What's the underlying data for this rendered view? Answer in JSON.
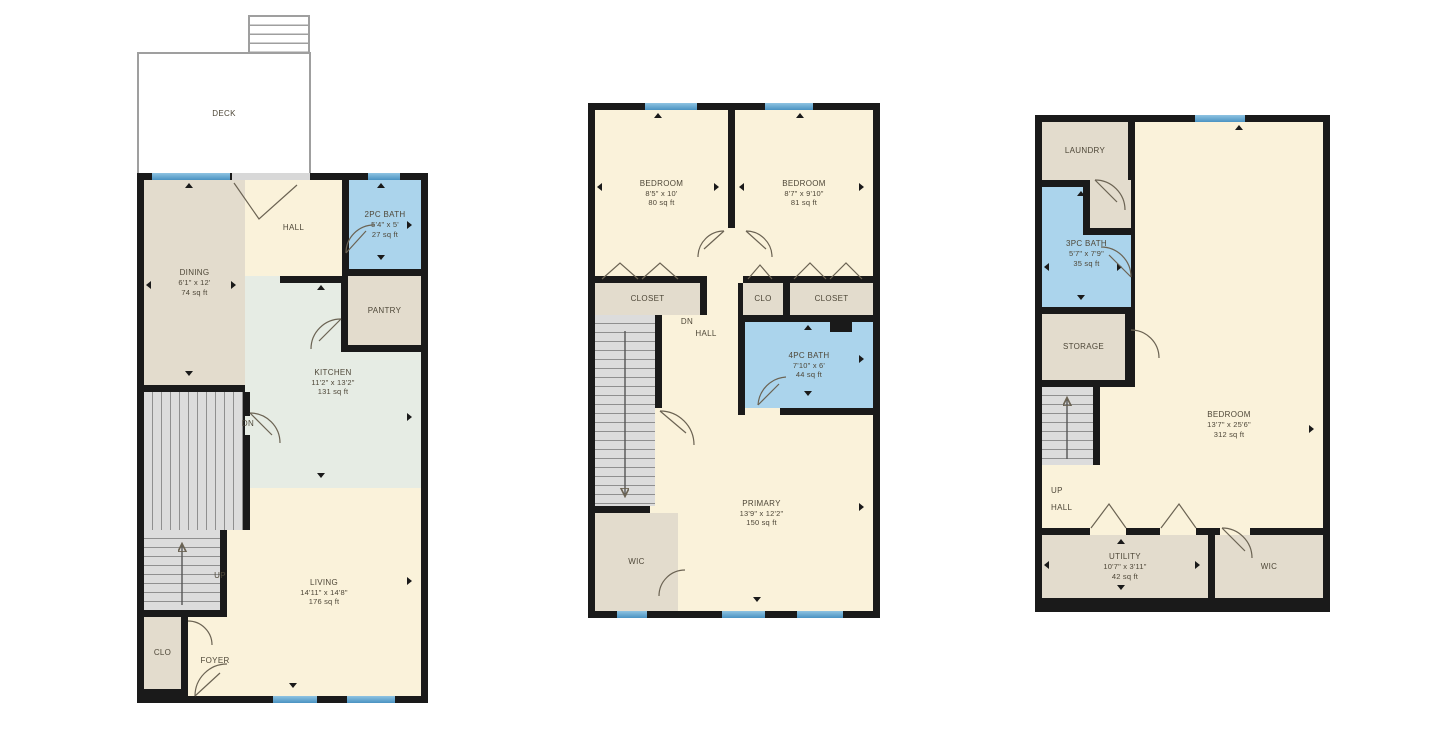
{
  "palette": {
    "wall": "#1a1a1a",
    "floor_cream": "#faf2da",
    "floor_tan": "#e3dccd",
    "bath_blue": "#abd4ec",
    "kitchen_green": "#e6ece4",
    "stairs_gray": "#dcdcdc",
    "window_blue": "#4a92c2",
    "label_text": "#4e4738",
    "background": "#ffffff"
  },
  "floor1": {
    "deck": {
      "label": "DECK"
    },
    "hall": {
      "label": "HALL"
    },
    "bath": {
      "label": "2PC BATH",
      "dims": "5'4\" x 5'",
      "area": "27 sq ft"
    },
    "dining": {
      "label": "DINING",
      "dims": "6'1\" x 12'",
      "area": "74 sq ft"
    },
    "pantry": {
      "label": "PANTRY"
    },
    "kitchen": {
      "label": "KITCHEN",
      "dims": "11'2\" x 13'2\"",
      "area": "131 sq ft"
    },
    "stairs_dn": {
      "label": "DN"
    },
    "stairs_up": {
      "label": "UP"
    },
    "living": {
      "label": "LIVING",
      "dims": "14'11\" x 14'8\"",
      "area": "176 sq ft"
    },
    "closet": {
      "label": "CLO"
    },
    "foyer": {
      "label": "FOYER"
    }
  },
  "floor2": {
    "bedroom_left": {
      "label": "BEDROOM",
      "dims": "8'5\" x 10'",
      "area": "80 sq ft"
    },
    "bedroom_right": {
      "label": "BEDROOM",
      "dims": "8'7\" x 9'10\"",
      "area": "81 sq ft"
    },
    "closet_left": {
      "label": "CLOSET"
    },
    "clo": {
      "label": "CLO"
    },
    "closet_right": {
      "label": "CLOSET"
    },
    "bath": {
      "label": "4PC BATH",
      "dims": "7'10\" x 6'",
      "area": "44 sq ft"
    },
    "stairs_dn": {
      "label": "DN"
    },
    "hall": {
      "label": "HALL"
    },
    "primary": {
      "label": "PRIMARY",
      "dims": "13'9\" x 12'2\"",
      "area": "150 sq ft"
    },
    "wic": {
      "label": "WIC"
    }
  },
  "floor3": {
    "laundry": {
      "label": "LAUNDRY"
    },
    "bath": {
      "label": "3PC BATH",
      "dims": "5'7\" x 7'9\"",
      "area": "35 sq ft"
    },
    "storage": {
      "label": "STORAGE"
    },
    "bedroom": {
      "label": "BEDROOM",
      "dims": "13'7\" x 25'6\"",
      "area": "312 sq ft"
    },
    "stairs_up": {
      "label": "UP"
    },
    "hall": {
      "label": "HALL"
    },
    "utility": {
      "label": "UTILITY",
      "dims": "10'7\" x 3'11\"",
      "area": "42 sq ft"
    },
    "wic": {
      "label": "WIC"
    }
  }
}
